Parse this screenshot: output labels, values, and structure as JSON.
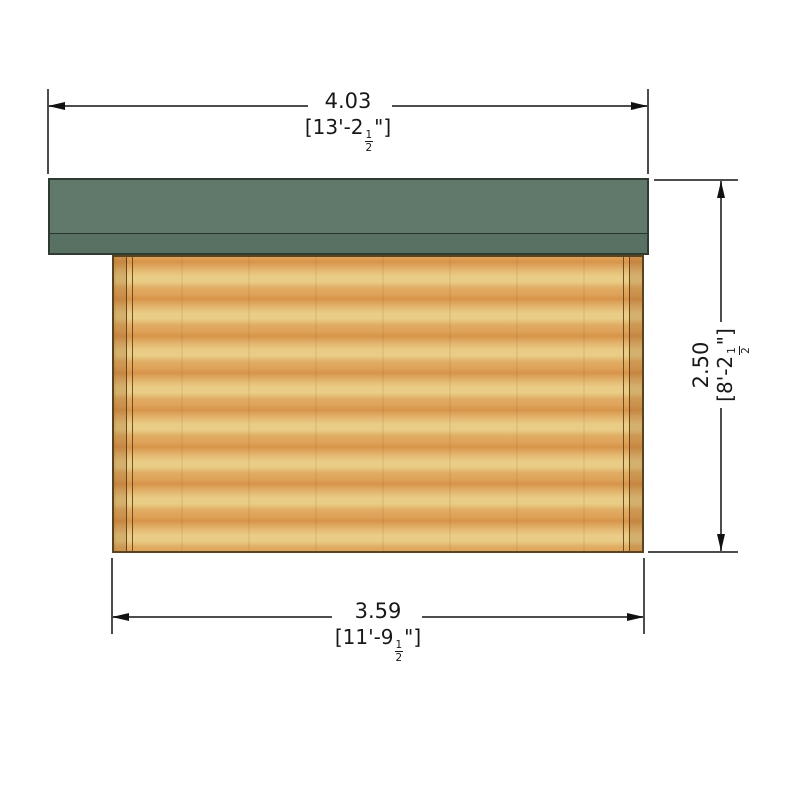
{
  "dimensions": {
    "top_width": {
      "metric": "4.03",
      "imperial_prefix": "[13'-2",
      "fraction_num": "1",
      "fraction_den": "2",
      "imperial_suffix": "\"]"
    },
    "right_height": {
      "metric": "2.50",
      "imperial_prefix": "[8'-2",
      "fraction_num": "1",
      "fraction_den": "2",
      "imperial_suffix": "\"]"
    },
    "bottom_width": {
      "metric": "3.59",
      "imperial_prefix": "[11'-9",
      "fraction_num": "1",
      "fraction_den": "2",
      "imperial_suffix": "\"]"
    }
  },
  "colors": {
    "roof_main": "#60796A",
    "roof_fascia": "#597163",
    "roof_outline": "#2E3A32",
    "wood_light": "#E9CC85",
    "wood_dark": "#D7944A",
    "wall_outline": "#5A4420",
    "line": "#4D4D4D",
    "arrow": "#111111",
    "text": "#181818",
    "page_bg": "#FFFFFF"
  }
}
